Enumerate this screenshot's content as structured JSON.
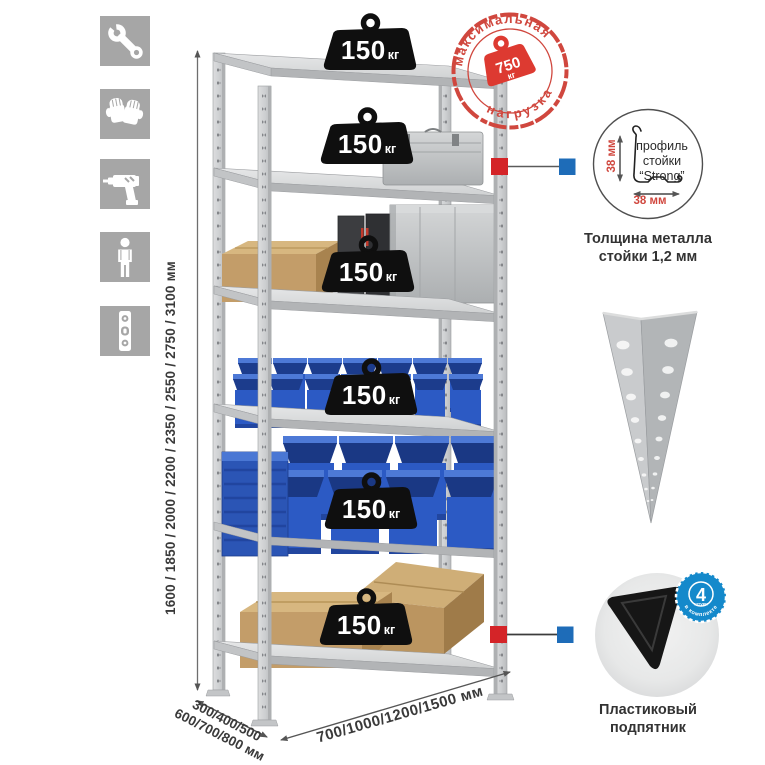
{
  "left_icons": [
    {
      "name": "wrench-icon"
    },
    {
      "name": "gloves-icon"
    },
    {
      "name": "drill-icon"
    },
    {
      "name": "person-icon"
    },
    {
      "name": "level-icon"
    }
  ],
  "dimensions": {
    "height": "1600 / 1850 / 2000 / 2200 / 2350 / 2550 / 2750 / 3100 мм",
    "depth_line1": "300/400/500",
    "depth_line2": "600/700/800 мм",
    "width": "700/1000/1200/1500 мм"
  },
  "max_load_stamp": {
    "arc_top": "максимальная",
    "arc_bottom": "нагрузка",
    "value": "750",
    "unit": "кг",
    "color": "#d0473e"
  },
  "shelf_loads": [
    {
      "value": "150",
      "unit": "кг"
    },
    {
      "value": "150",
      "unit": "кг"
    },
    {
      "value": "150",
      "unit": "кг"
    },
    {
      "value": "150",
      "unit": "кг"
    },
    {
      "value": "150",
      "unit": "кг"
    },
    {
      "value": "150",
      "unit": "кг"
    }
  ],
  "profile_detail": {
    "line1": "профиль",
    "line2": "стойки",
    "line3": "“Strong”",
    "dim_vertical": "38 мм",
    "dim_horizontal": "38 мм",
    "caption_line1": "Толщина металла",
    "caption_line2": "стойки 1,2 мм"
  },
  "foot_detail": {
    "badge_value": "4",
    "badge_sub": "штуки",
    "badge_arc": "в комплекте",
    "caption_line1": "Пластиковый",
    "caption_line2": "подпятник"
  },
  "colors": {
    "accent_red": "#d0473e",
    "marker_red": "#d42428",
    "marker_blue": "#1e6cb8",
    "badge_blue": "#1489cb",
    "bin_blue": "#2c5ac4"
  }
}
